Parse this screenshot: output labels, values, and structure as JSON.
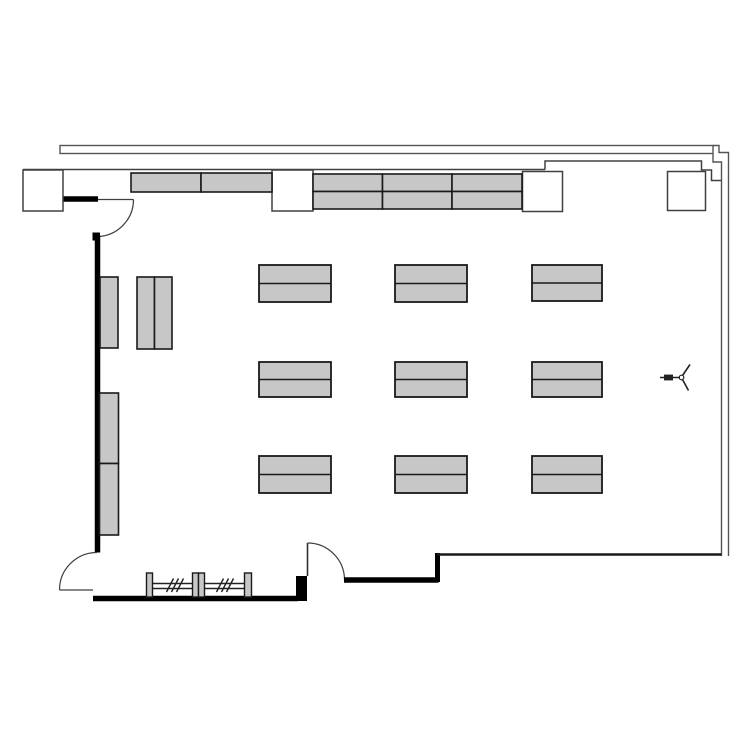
{
  "drawing": {
    "kind": "architectural-floor-plan",
    "canvas": {
      "w": 750,
      "h": 750,
      "bg": "#ffffff"
    }
  },
  "colors": {
    "furniture_fill": "#c7c7c7",
    "furniture_stroke": "#1a1a1a",
    "wall": "#000000",
    "thin_line": "#404040",
    "outer_line": "#555555",
    "pier_fill": "#ffffff",
    "rail_line": "#222222"
  },
  "elements": {
    "desks": [
      {
        "x": 259,
        "y": 265,
        "w": 72,
        "h": 37
      },
      {
        "x": 395,
        "y": 265,
        "w": 72,
        "h": 37
      },
      {
        "x": 532,
        "y": 265,
        "w": 70,
        "h": 36
      },
      {
        "x": 259,
        "y": 362,
        "w": 72,
        "h": 35
      },
      {
        "x": 395,
        "y": 362,
        "w": 72,
        "h": 35
      },
      {
        "x": 532,
        "y": 362,
        "w": 70,
        "h": 35
      },
      {
        "x": 259,
        "y": 456,
        "w": 72,
        "h": 37
      },
      {
        "x": 395,
        "y": 456,
        "w": 72,
        "h": 37
      },
      {
        "x": 532,
        "y": 456,
        "w": 70,
        "h": 37
      }
    ],
    "wall_counters": [
      {
        "x": 131,
        "y": 173,
        "w": 70,
        "h": 19
      },
      {
        "x": 201,
        "y": 173,
        "w": 71,
        "h": 19
      },
      {
        "x": 313,
        "y": 174,
        "w": 69.5,
        "h": 17.5
      },
      {
        "x": 382.5,
        "y": 174,
        "w": 69.5,
        "h": 17.5
      },
      {
        "x": 452,
        "y": 174,
        "w": 70,
        "h": 17.5
      },
      {
        "x": 313,
        "y": 191.5,
        "w": 69.5,
        "h": 17.5
      },
      {
        "x": 382.5,
        "y": 191.5,
        "w": 69.5,
        "h": 17.5
      },
      {
        "x": 452,
        "y": 191.5,
        "w": 70,
        "h": 17.5
      }
    ],
    "side_cabinets": [
      {
        "x": 100,
        "y": 277,
        "w": 18,
        "h": 71
      },
      {
        "x": 137,
        "y": 277,
        "w": 17.5,
        "h": 72
      },
      {
        "x": 154.5,
        "y": 277,
        "w": 17.5,
        "h": 72
      },
      {
        "x": 99.5,
        "y": 393,
        "w": 19,
        "h": 70.5
      },
      {
        "x": 99.5,
        "y": 463.5,
        "w": 19,
        "h": 71.5
      }
    ],
    "piers": [
      {
        "x": 23,
        "y": 170,
        "w": 40,
        "h": 41
      },
      {
        "x": 272,
        "y": 170,
        "w": 41,
        "h": 41
      },
      {
        "x": 522.5,
        "y": 171.5,
        "w": 40,
        "h": 40
      },
      {
        "x": 667.5,
        "y": 171.5,
        "w": 38,
        "h": 39
      }
    ],
    "rail": {
      "posts": [
        {
          "x": 146.5,
          "y": 573,
          "w": 6,
          "h": 24
        },
        {
          "x": 192.5,
          "y": 573,
          "w": 6,
          "h": 24
        },
        {
          "x": 198.5,
          "y": 573,
          "w": 6,
          "h": 24
        },
        {
          "x": 244.5,
          "y": 573,
          "w": 7,
          "h": 24
        }
      ],
      "rail_x1": 147,
      "rail_x2": 251.5,
      "rail_y": [
        583.5,
        588.5
      ],
      "hatch_groups": [
        {
          "cx": 175
        },
        {
          "cx": 225
        }
      ],
      "hatch_slash": {
        "dx": 7,
        "y_bottom": 592,
        "y_top": 578.5,
        "spacing": 5,
        "count": 3
      }
    }
  }
}
